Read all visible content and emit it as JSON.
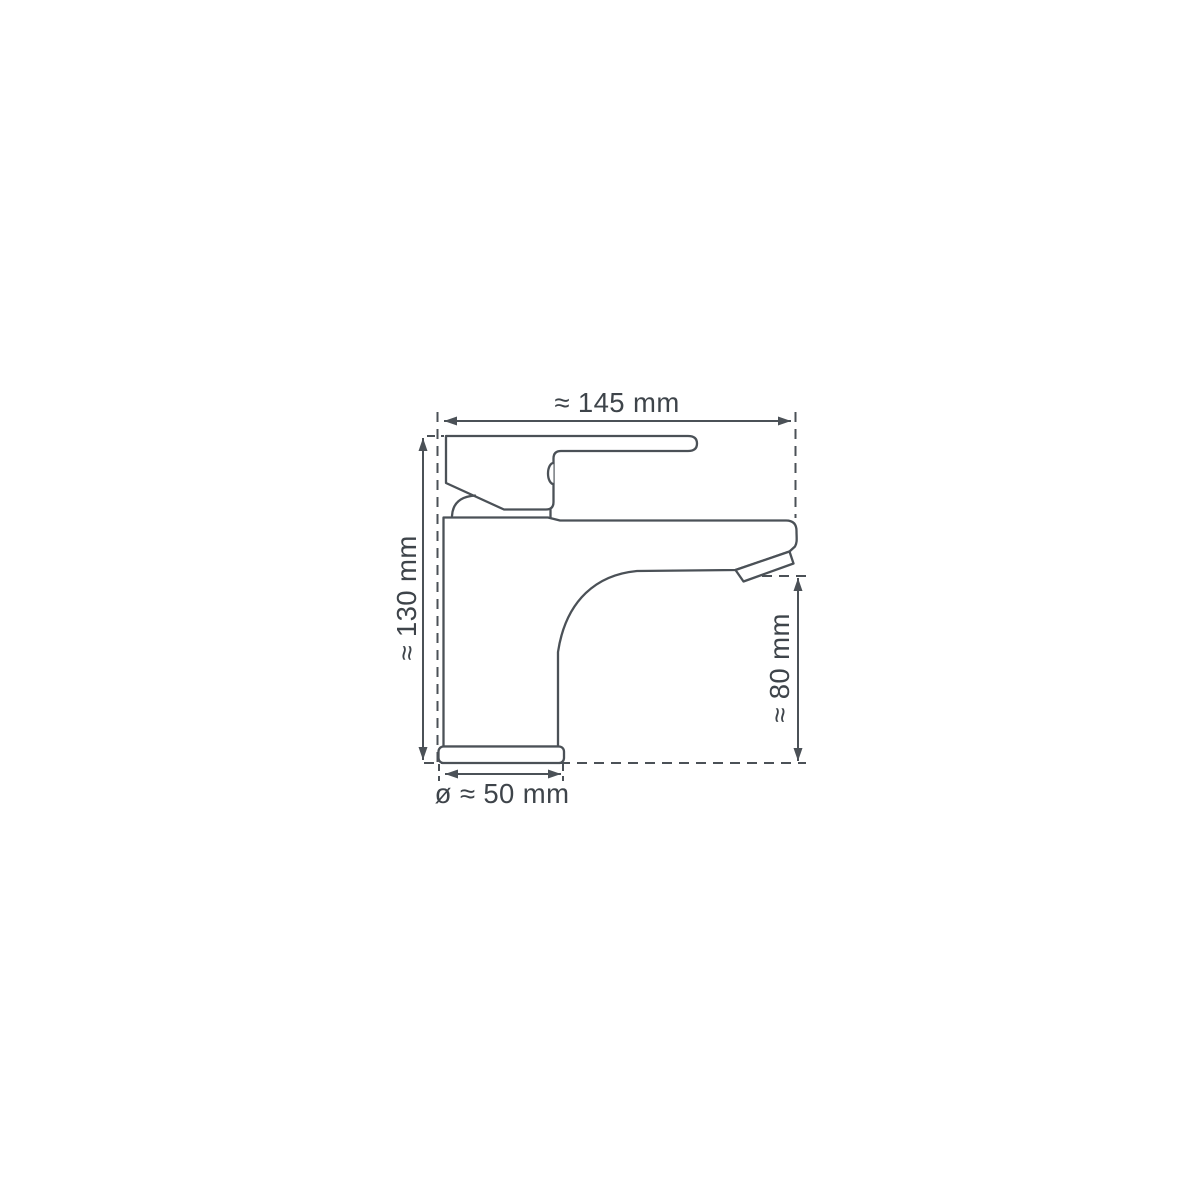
{
  "colors": {
    "line": "#4b5157",
    "text": "#3e444a",
    "background": "#ffffff"
  },
  "dimension_labels": {
    "width": "≈ 145 mm",
    "height": "≈ 130 mm",
    "spout_height": "≈ 80 mm",
    "base_diameter": "ø ≈ 50 mm"
  }
}
